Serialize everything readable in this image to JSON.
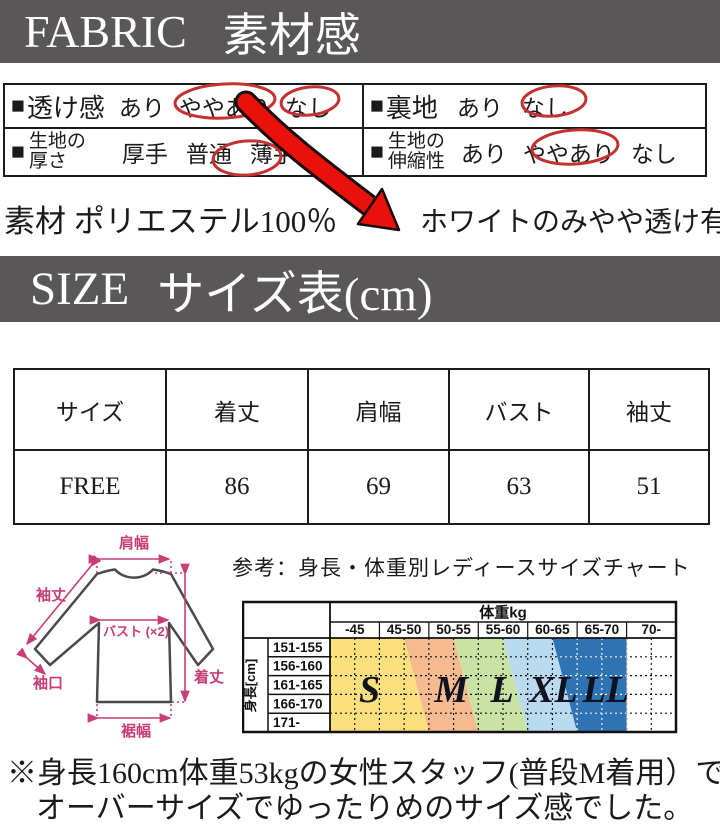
{
  "colors": {
    "banner_bg": "#595757",
    "banner_text": "#ffffff",
    "table_border": "#1c1c1c",
    "circle_red": "#c53030",
    "arrow_red": "#e8120b",
    "annotation_pink": "#c73d78",
    "garment_outline": "#4c4948"
  },
  "fabric": {
    "banner_en": "FABRIC",
    "banner_ja": "素材感",
    "cells": [
      {
        "id": "sheerness",
        "bullet": "■",
        "label": "透け感",
        "label2": "",
        "options": [
          {
            "t": "あり",
            "c": false
          },
          {
            "t": "ややあり",
            "c": true
          },
          {
            "t": "なし",
            "c": true
          }
        ]
      },
      {
        "id": "lining",
        "bullet": "■",
        "label": "裏地",
        "label2": "",
        "options": [
          {
            "t": "あり",
            "c": false
          },
          {
            "t": "なし",
            "c": true
          }
        ]
      },
      {
        "id": "thickness",
        "bullet": "■",
        "label": "生地の",
        "label2": "厚さ",
        "options": [
          {
            "t": "厚手",
            "c": false
          },
          {
            "t": "普通",
            "c": false
          },
          {
            "t": "薄手",
            "c": true
          }
        ]
      },
      {
        "id": "stretch",
        "bullet": "■",
        "label": "生地の",
        "label2": "伸縮性",
        "options": [
          {
            "t": "あり",
            "c": false
          },
          {
            "t": "ややあり",
            "c": true
          },
          {
            "t": "なし",
            "c": false
          }
        ]
      }
    ]
  },
  "material": {
    "composition": "素材 ポリエステル100％",
    "note": "ホワイトのみやや透け有"
  },
  "size_section": {
    "banner_en": "SIZE",
    "banner_ja": "サイズ表(cm)"
  },
  "size_table": {
    "headers": [
      "サイズ",
      "着丈",
      "肩幅",
      "バスト",
      "袖丈"
    ],
    "rows": [
      [
        "FREE",
        "86",
        "69",
        "63",
        "51"
      ]
    ]
  },
  "garment": {
    "labels": {
      "shoulder": "肩幅",
      "sleeve": "袖丈",
      "bust": "バスト (×2)",
      "cuff": "袖口",
      "length": "着丈",
      "hem": "裾幅"
    }
  },
  "reference_text": "参考：身長・体重別レディースサイズチャート",
  "chart_data": {
    "type": "heatmap",
    "title": "体重kg",
    "row_axis_label": "身長[cm]",
    "columns": [
      "-45",
      "45-50",
      "50-55",
      "55-60",
      "60-65",
      "65-70",
      "70-"
    ],
    "rows": [
      "151-155",
      "156-160",
      "161-165",
      "166-170",
      "171-"
    ],
    "bands": [
      {
        "label": "S",
        "color": "#fbe07d",
        "right_top_col": 1.5,
        "right_bottom_col": 2.0,
        "label_col": 0.8
      },
      {
        "label": "M",
        "color": "#f5ba90",
        "right_top_col": 2.5,
        "right_bottom_col": 3.0,
        "label_col": 2.45
      },
      {
        "label": "L",
        "color": "#c8e3a4",
        "right_top_col": 3.5,
        "right_bottom_col": 4.0,
        "label_col": 3.48
      },
      {
        "label": "XL",
        "color": "#badaf0",
        "right_top_col": 4.5,
        "right_bottom_col": 5.0,
        "label_col": 4.52
      },
      {
        "label": "LL",
        "color": "#2e74b5",
        "right_top_col": 6.0,
        "right_bottom_col": 6.0,
        "label_col": 5.58
      }
    ]
  },
  "note": {
    "line1": "※身長160cm体重53kgの女性スタッフ(普段M着用）で",
    "line2": "オーバーサイズでゆったりめのサイズ感でした。"
  }
}
